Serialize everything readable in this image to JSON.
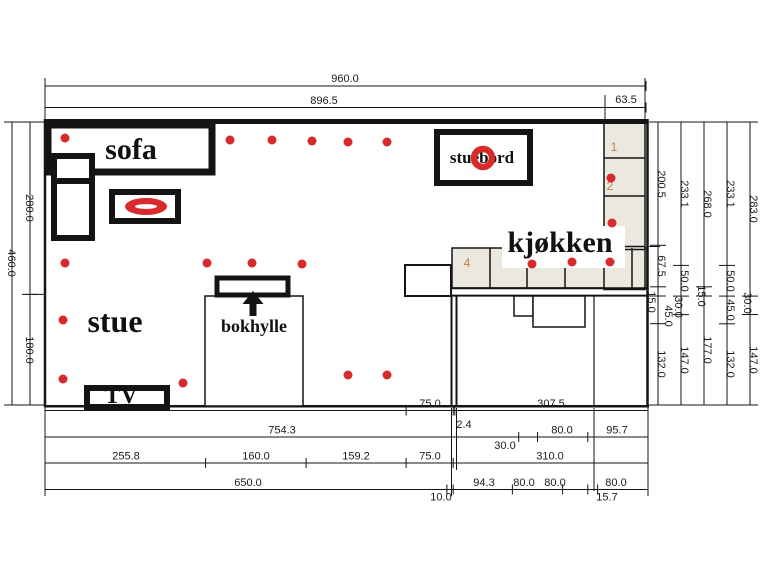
{
  "labels": {
    "sofa": "sofa",
    "stue": "stue",
    "bokhylle": "bokhylle",
    "kjokken": "kjøkken",
    "stuebord": "stuebord",
    "tv": "TV",
    "cabinet_1": "1",
    "cabinet_2": "2",
    "cabinet_4": "4"
  },
  "dimensions": {
    "top": [
      "960.0",
      "896.5",
      "63.5"
    ],
    "left": [
      "460.0",
      "280.0",
      "180.0"
    ],
    "right_chains": [
      [
        "200.5",
        "67.5",
        "15.0",
        "45.0",
        "132.0"
      ],
      [
        "233.1",
        "50.0",
        "30.0",
        "147.0"
      ],
      [
        "268.0",
        "15.0",
        "177.0"
      ],
      [
        "233.1",
        "50.0",
        "45.0",
        "132.0"
      ],
      [
        "283.0",
        "30.0",
        "147.0"
      ]
    ],
    "bottom_rows": [
      [
        "575.0",
        "75.0",
        "2.4",
        "307.5"
      ],
      [
        "754.3",
        "30.0",
        "80.0",
        "95.7"
      ],
      [
        "255.8",
        "160.0",
        "159.2",
        "75.0",
        "310.0"
      ],
      [
        "650.0",
        "10.0",
        "94.3",
        "80.0",
        "80.0",
        "15.7",
        "80.0"
      ]
    ]
  },
  "colors": {
    "line": "#141414",
    "accent_red": "#d82a2a",
    "cabinet_fill": "#ebe9df",
    "cabinet_label": "#c07f42",
    "background": "#ffffff"
  },
  "drawing": {
    "width": 760,
    "height": 570,
    "rects_under": [
      {
        "name": "kitchen-counter-band",
        "x": 452,
        "y": 248,
        "w": 195,
        "h": 40,
        "fill": "#ebe9df",
        "sw": 1.5
      },
      {
        "name": "kitchen-cabinet-column",
        "x": 604,
        "y": 122.5,
        "w": 41,
        "h": 167,
        "fill": "#ebe9df",
        "sw": 1.5
      }
    ],
    "seplines": [
      {
        "name": "counter-separator",
        "x1": 490,
        "y1": 248,
        "x2": 490,
        "y2": 288,
        "w": 1.5
      },
      {
        "name": "counter-separator",
        "x1": 527,
        "y1": 248,
        "x2": 527,
        "y2": 288,
        "w": 1.5
      },
      {
        "name": "counter-separator",
        "x1": 565,
        "y1": 248,
        "x2": 565,
        "y2": 288,
        "w": 1.5
      },
      {
        "name": "counter-separator",
        "x1": 632,
        "y1": 248,
        "x2": 632,
        "y2": 288,
        "w": 1.5
      },
      {
        "name": "column-separator",
        "x1": 604,
        "y1": 158,
        "x2": 645,
        "y2": 158,
        "w": 1.5
      },
      {
        "name": "column-separator",
        "x1": 604,
        "y1": 196,
        "x2": 645,
        "y2": 196,
        "w": 1.5
      },
      {
        "name": "column-separator",
        "x1": 604,
        "y1": 246.5,
        "x2": 645,
        "y2": 246.5,
        "w": 1.5
      },
      {
        "name": "column-separator",
        "x1": 604,
        "y1": 249.5,
        "x2": 645,
        "y2": 249.5,
        "w": 1.5
      }
    ],
    "rects_over": [
      {
        "name": "kjokken-label-plate",
        "x": 502,
        "y": 226,
        "w": 123,
        "h": 42,
        "fill": "#ffffff",
        "sw": 0
      },
      {
        "name": "sofa-outline",
        "x": 48,
        "y": 125,
        "w": 164,
        "h": 47,
        "sw": 7
      },
      {
        "name": "sofa-chaise-small",
        "x": 54,
        "y": 156,
        "w": 38,
        "h": 25,
        "sw": 6
      },
      {
        "name": "sofa-chaise-large",
        "x": 54,
        "y": 181,
        "w": 38,
        "h": 57,
        "sw": 6
      },
      {
        "name": "coffee-table-outline",
        "x": 112,
        "y": 192,
        "w": 66,
        "h": 29,
        "sw": 6
      },
      {
        "name": "stuebord-outline",
        "x": 437,
        "y": 132,
        "w": 93,
        "h": 51,
        "sw": 6
      },
      {
        "name": "bokhylle-room-outline",
        "x": 205,
        "y": 296,
        "w": 98,
        "h": 110,
        "sw": 1.5
      },
      {
        "name": "bokhylle-shelf-outline",
        "x": 217,
        "y": 278,
        "w": 71,
        "h": 17,
        "sw": 5
      },
      {
        "name": "tv-outline",
        "x": 87,
        "y": 388,
        "w": 80,
        "h": 19,
        "sw": 6
      },
      {
        "name": "door-opening-box",
        "x": 405,
        "y": 265,
        "w": 46,
        "h": 31,
        "sw": 2
      },
      {
        "name": "step-box-small",
        "x": 514,
        "y": 296,
        "w": 19,
        "h": 20,
        "sw": 1.5
      },
      {
        "name": "step-box-large",
        "x": 533,
        "y": 296,
        "w": 52,
        "h": 31,
        "sw": 1.5
      }
    ],
    "walls": [
      {
        "name": "wall-top",
        "x1": 44,
        "y1": 121.5,
        "x2": 648,
        "y2": 121.5,
        "w": 5
      },
      {
        "name": "wall-left",
        "x1": 45,
        "y1": 119,
        "x2": 45,
        "y2": 407,
        "w": 2.5
      },
      {
        "name": "wall-right",
        "x1": 647.5,
        "y1": 119,
        "x2": 647.5,
        "y2": 407,
        "w": 2.5
      },
      {
        "name": "wall-bottom",
        "x1": 44,
        "y1": 406.2,
        "x2": 649,
        "y2": 406.2,
        "w": 2.5
      },
      {
        "name": "wall-kitchen-h1",
        "x1": 452,
        "y1": 288.3,
        "x2": 647,
        "y2": 288.3,
        "w": 2
      },
      {
        "name": "wall-kitchen-h2",
        "x1": 452,
        "y1": 295.6,
        "x2": 647,
        "y2": 295.6,
        "w": 2
      },
      {
        "name": "wall-kitchen-v1",
        "x1": 451.5,
        "y1": 295.6,
        "x2": 451.5,
        "y2": 406,
        "w": 2
      },
      {
        "name": "wall-kitchen-v2",
        "x1": 456.5,
        "y1": 295.6,
        "x2": 456.5,
        "y2": 406,
        "w": 2
      },
      {
        "name": "wall-interior-v",
        "x1": 594,
        "y1": 296,
        "x2": 594,
        "y2": 406,
        "w": 1.2
      }
    ],
    "extlines": [
      {
        "name": "ext-top-left",
        "x1": 45,
        "y1": 78,
        "x2": 45,
        "y2": 119,
        "w": 1
      },
      {
        "name": "ext-top-mid",
        "x1": 605,
        "y1": 95,
        "x2": 605,
        "y2": 119,
        "w": 1
      },
      {
        "name": "ext-top-right",
        "x1": 645,
        "y1": 78,
        "x2": 645,
        "y2": 119,
        "w": 1
      },
      {
        "name": "ext-left-top",
        "x1": 8,
        "y1": 122,
        "x2": 44,
        "y2": 122,
        "w": 1
      },
      {
        "name": "ext-left-mid",
        "x1": 26,
        "y1": 294.4,
        "x2": 44,
        "y2": 294.4,
        "w": 1
      },
      {
        "name": "ext-left-bottom",
        "x1": 8,
        "y1": 405,
        "x2": 44,
        "y2": 405,
        "w": 1
      },
      {
        "name": "ext-right-top",
        "x1": 649,
        "y1": 122,
        "x2": 757,
        "y2": 122,
        "w": 1
      },
      {
        "name": "ext-right-bottom",
        "x1": 649,
        "y1": 405,
        "x2": 757,
        "y2": 405,
        "w": 1
      },
      {
        "name": "ext-right-c1",
        "x1": 649,
        "y1": 246.5,
        "x2": 660,
        "y2": 246.5,
        "w": 1
      },
      {
        "name": "ext-right-c2",
        "x1": 649,
        "y1": 296,
        "x2": 660,
        "y2": 296,
        "w": 1
      },
      {
        "name": "ext-bottom-1",
        "x1": 45,
        "y1": 408,
        "x2": 45,
        "y2": 496,
        "w": 1
      },
      {
        "name": "ext-bottom-2",
        "x1": 451.5,
        "y1": 408,
        "x2": 451.5,
        "y2": 496,
        "w": 1
      },
      {
        "name": "ext-bottom-3",
        "x1": 456.5,
        "y1": 408,
        "x2": 456.5,
        "y2": 470,
        "w": 1
      },
      {
        "name": "ext-bottom-4",
        "x1": 594,
        "y1": 408,
        "x2": 594,
        "y2": 491,
        "w": 1
      },
      {
        "name": "ext-bottom-5",
        "x1": 648,
        "y1": 408,
        "x2": 648,
        "y2": 496,
        "w": 1
      }
    ],
    "dims_h": [
      {
        "name": "dim-top-960",
        "y": 86,
        "x1": 45,
        "x2": 646,
        "ticks": [
          45,
          646
        ],
        "texts": [
          {
            "t": "960.0",
            "x": 345,
            "y": 82
          }
        ]
      },
      {
        "name": "dim-top-896",
        "y": 107.5,
        "x1": 45,
        "x2": 646,
        "ticks": [
          45,
          605,
          646
        ],
        "texts": [
          {
            "t": "896.5",
            "x": 324,
            "y": 104
          },
          {
            "t": "63.5",
            "x": 626,
            "y": 103
          }
        ]
      },
      {
        "name": "dim-bottom-row1",
        "y": 410.5,
        "x1": 45,
        "x2": 648,
        "ticks": [
          45,
          406.1,
          453.2,
          454.8,
          648
        ],
        "texts": [
          {
            "t": "575.0",
            "x": 226,
            "y": 407
          },
          {
            "t": "75.0",
            "x": 430,
            "y": 407
          },
          {
            "t": "2.4",
            "x": 464,
            "y": 428
          },
          {
            "t": "307.5",
            "x": 551,
            "y": 407
          }
        ]
      },
      {
        "name": "dim-bottom-row2",
        "y": 437,
        "x1": 45,
        "x2": 648,
        "ticks": [
          45,
          518.7,
          537.5,
          587.8,
          648
        ],
        "texts": [
          {
            "t": "754.3",
            "x": 282,
            "y": 433.5
          },
          {
            "t": "30.0",
            "x": 505,
            "y": 449
          },
          {
            "t": "80.0",
            "x": 562,
            "y": 433.5
          },
          {
            "t": "95.7",
            "x": 617,
            "y": 433.5
          }
        ]
      },
      {
        "name": "dim-bottom-row3",
        "y": 463,
        "x1": 45,
        "x2": 648,
        "ticks": [
          45,
          205.6,
          306.1,
          406.1,
          453.2,
          648
        ],
        "texts": [
          {
            "t": "255.8",
            "x": 126,
            "y": 459.5
          },
          {
            "t": "160.0",
            "x": 256,
            "y": 459.5
          },
          {
            "t": "159.2",
            "x": 356,
            "y": 459.5
          },
          {
            "t": "75.0",
            "x": 430,
            "y": 459.5
          },
          {
            "t": "310.0",
            "x": 550,
            "y": 459.5
          }
        ]
      },
      {
        "name": "dim-bottom-row4",
        "y": 489.5,
        "x1": 45,
        "x2": 648,
        "ticks": [
          45,
          446.9,
          453.2,
          512.4,
          562.6,
          587.8,
          597.6,
          648
        ],
        "texts": [
          {
            "t": "650.0",
            "x": 248,
            "y": 486
          },
          {
            "t": "10.0",
            "x": 441,
            "y": 500.5
          },
          {
            "t": "94.3",
            "x": 484,
            "y": 486
          },
          {
            "t": "80.0",
            "x": 524,
            "y": 486
          },
          {
            "t": "80.0",
            "x": 555,
            "y": 486
          },
          {
            "t": "15.7",
            "x": 607,
            "y": 500.5
          },
          {
            "t": "80.0",
            "x": 616,
            "y": 486
          }
        ]
      }
    ],
    "dims_v": [
      {
        "name": "dim-left-460",
        "x": 12,
        "y1": 122,
        "y2": 405,
        "ticks": [
          122,
          405
        ],
        "texts": [
          {
            "t": "460.0",
            "x": 8,
            "y": 263
          }
        ]
      },
      {
        "name": "dim-left-280-180",
        "x": 30,
        "y1": 122,
        "y2": 405,
        "ticks": [
          122,
          294.4,
          405
        ],
        "texts": [
          {
            "t": "280.0",
            "x": 26,
            "y": 208
          },
          {
            "t": "180.0",
            "x": 26,
            "y": 350
          }
        ]
      },
      {
        "name": "dim-right-1",
        "x": 658,
        "y1": 122,
        "y2": 405,
        "ticks": [
          122,
          245.3,
          286.8,
          296,
          323.7,
          405
        ],
        "texts": [
          {
            "t": "200.5",
            "x": 658,
            "y": 184
          },
          {
            "t": "67.5",
            "x": 658,
            "y": 266
          },
          {
            "t": "15.0",
            "x": 648,
            "y": 302
          },
          {
            "t": "45.0",
            "x": 665,
            "y": 316
          },
          {
            "t": "132.0",
            "x": 658,
            "y": 364
          }
        ]
      },
      {
        "name": "dim-right-2",
        "x": 681,
        "y1": 122,
        "y2": 405,
        "ticks": [
          122,
          265.4,
          296.1,
          314.6,
          405
        ],
        "texts": [
          {
            "t": "233.1",
            "x": 681,
            "y": 194
          },
          {
            "t": "50.0",
            "x": 681,
            "y": 281
          },
          {
            "t": "30.0",
            "x": 675,
            "y": 307
          },
          {
            "t": "147.0",
            "x": 681,
            "y": 360
          }
        ]
      },
      {
        "name": "dim-right-3",
        "x": 704,
        "y1": 122,
        "y2": 405,
        "ticks": [
          122,
          286.8,
          296,
          405
        ],
        "texts": [
          {
            "t": "268.0",
            "x": 704,
            "y": 204
          },
          {
            "t": "15.0",
            "x": 698,
            "y": 296
          },
          {
            "t": "177.0",
            "x": 704,
            "y": 350
          }
        ]
      },
      {
        "name": "dim-right-4",
        "x": 727,
        "y1": 122,
        "y2": 405,
        "ticks": [
          122,
          265.4,
          296.1,
          323.8,
          405
        ],
        "texts": [
          {
            "t": "233.1",
            "x": 727,
            "y": 194
          },
          {
            "t": "50.0",
            "x": 727,
            "y": 281
          },
          {
            "t": "45.0",
            "x": 727,
            "y": 310
          },
          {
            "t": "132.0",
            "x": 727,
            "y": 364
          }
        ]
      },
      {
        "name": "dim-right-5",
        "x": 750,
        "y1": 122,
        "y2": 405,
        "ticks": [
          122,
          296.1,
          314.5,
          405
        ],
        "texts": [
          {
            "t": "283.0",
            "x": 750,
            "y": 209
          },
          {
            "t": "30.0",
            "x": 744,
            "y": 303
          },
          {
            "t": "147.0",
            "x": 750,
            "y": 360
          }
        ]
      }
    ],
    "room_texts": [
      {
        "name": "label-sofa",
        "bind": "labels.sofa",
        "x": 131,
        "y": 159,
        "size": 30,
        "serif": true,
        "bold": true,
        "fill": "#111111"
      },
      {
        "name": "label-stue",
        "bind": "labels.stue",
        "x": 115,
        "y": 332,
        "size": 32,
        "serif": true,
        "bold": true,
        "fill": "#111111"
      },
      {
        "name": "label-bokhylle",
        "bind": "labels.bokhylle",
        "x": 254,
        "y": 332,
        "size": 18,
        "serif": true,
        "bold": true,
        "fill": "#111111"
      },
      {
        "name": "label-kjokken",
        "bind": "labels.kjokken",
        "x": 560,
        "y": 252,
        "size": 30,
        "serif": true,
        "bold": true,
        "fill": "#111111"
      },
      {
        "name": "label-stuebord",
        "bind": "labels.stuebord",
        "x": 482,
        "y": 163,
        "size": 17,
        "serif": true,
        "bold": true,
        "fill": "#111111"
      },
      {
        "name": "label-tv",
        "bind": "labels.tv",
        "x": 121,
        "y": 403,
        "size": 24,
        "serif": true,
        "bold": true,
        "fill": "#111111"
      },
      {
        "name": "cabinet-label-1",
        "bind": "labels.cabinet_1",
        "x": 614,
        "y": 151,
        "size": 12,
        "serif": false,
        "bold": false,
        "fill": "#c07f42"
      },
      {
        "name": "cabinet-label-2",
        "bind": "labels.cabinet_2",
        "x": 610,
        "y": 190,
        "size": 12,
        "serif": false,
        "bold": false,
        "fill": "#c07f42"
      },
      {
        "name": "cabinet-label-4",
        "bind": "labels.cabinet_4",
        "x": 467,
        "y": 267,
        "size": 12,
        "serif": false,
        "bold": false,
        "fill": "#c07f42"
      }
    ],
    "dots": [
      [
        65,
        138
      ],
      [
        230,
        140
      ],
      [
        272,
        140
      ],
      [
        312,
        141
      ],
      [
        348,
        142
      ],
      [
        387,
        142
      ],
      [
        65,
        263
      ],
      [
        207,
        263
      ],
      [
        252,
        263
      ],
      [
        302,
        264
      ],
      [
        63,
        320
      ],
      [
        63,
        379
      ],
      [
        183,
        383
      ],
      [
        348,
        375
      ],
      [
        387,
        375
      ],
      [
        611,
        178
      ],
      [
        612,
        223
      ],
      [
        532,
        264
      ],
      [
        572,
        262
      ],
      [
        610,
        262
      ]
    ],
    "dot_r": 4.5,
    "ring": {
      "cx": 483,
      "cy": 158,
      "r": 9,
      "sw": 6.5
    },
    "table_ellipse": {
      "cx": 146,
      "cy": 206.5,
      "rx": 21,
      "ry": 8.5,
      "inner_rx": 11,
      "inner_ry": 2.4
    },
    "arrow": {
      "head": "253,291 242.5,304 263.5,304",
      "stem": {
        "x": 249.5,
        "y": 303,
        "w": 7,
        "h": 13
      }
    }
  }
}
